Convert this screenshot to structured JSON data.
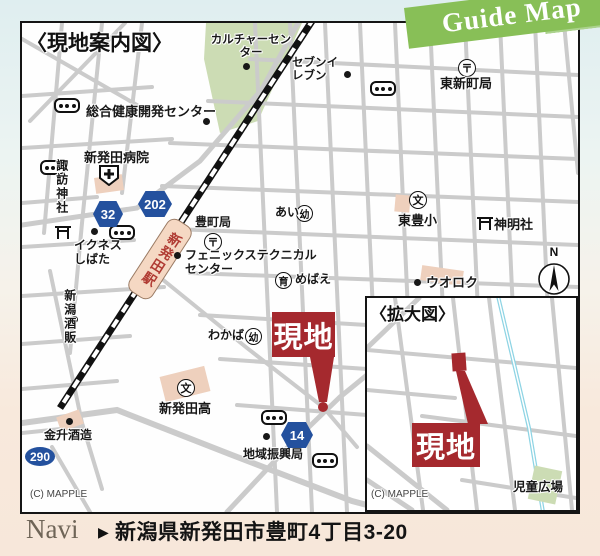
{
  "banner": {
    "text": "Guide Map"
  },
  "main_map": {
    "title": "〈現地案内図〉",
    "credit": "(C) MAPPLE",
    "station": {
      "name": "新発田駅"
    },
    "site_marker": {
      "label": "現地"
    },
    "compass": {
      "north": "N"
    },
    "route_badges": {
      "r32": "32",
      "r202": "202",
      "r14": "14",
      "r290": "290"
    },
    "symbols": {
      "post_office": "〒",
      "school": "文",
      "kindergarten": "幼",
      "nursery": "育"
    },
    "pois": {
      "culture_center": "カルチャーセンター",
      "seven_eleven": "セブンイレブン",
      "higashi_shinmachi_po": "東新町局",
      "sogo_kenko_center": "総合健康開発センター",
      "shibata_hospital": "新発田病院",
      "suwa_shrine": "諏訪神社",
      "iknes_shibata": "イクネスしばた",
      "toyomachi_po": "豊町局",
      "phoenix_technical": "フェニックステクニカルセンター",
      "ai_kindergarten": "あい",
      "mebae_nursery": "めばえ",
      "higashi_toyo_elementary": "東豊小",
      "shinmei_shrine": "神明社",
      "uoroku": "ウオロク",
      "niigata_shuhan": "新潟酒販",
      "wakaba_kindergarten": "わかば",
      "shibata_high_school": "新発田高",
      "kanemasu_brewery": "金升酒造",
      "chiiki_shinkokyoku": "地域振興局"
    }
  },
  "inset_map": {
    "title": "〈拡大図〉",
    "site_marker": {
      "label": "現地"
    },
    "park": "児童広場",
    "credit": "(C) MAPPLE"
  },
  "navi_bar": {
    "label": "Navi",
    "arrow": "▶",
    "address": "新潟県新発田市豊町4丁目3-20"
  },
  "colors": {
    "accent_red": "#a5292e",
    "route_badge_blue": "#24519e",
    "banner_green": "#88bf57",
    "road_gray": "#cbcbcb",
    "station_pink": "#f5d8c3",
    "park_green": "#ccdcb4",
    "background_top": "#dfeef0",
    "background_bottom": "#f7e7da"
  }
}
